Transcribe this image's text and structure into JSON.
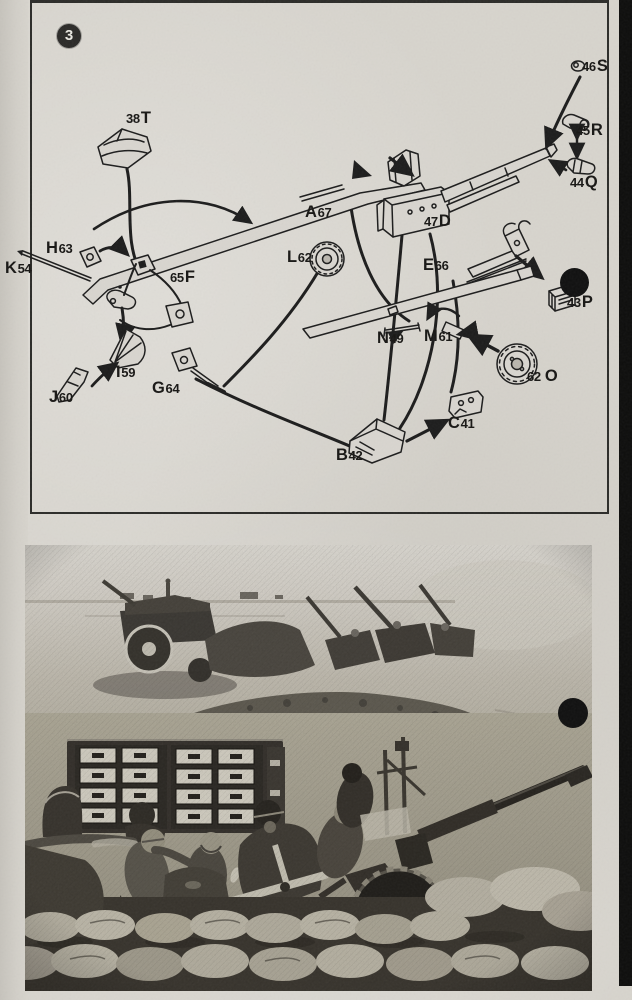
{
  "colors": {
    "paper": "#d7d4cd",
    "ink": "#1c1c1c"
  },
  "page": {
    "step_number": "3"
  },
  "diagram": {
    "parts": {
      "38T": {
        "num": "38",
        "letter": "T"
      },
      "46S": {
        "num": "46",
        "letter": "S"
      },
      "45R": {
        "num": "45",
        "letter": "R"
      },
      "44Q": {
        "num": "44",
        "letter": "Q"
      },
      "47D": {
        "num": "47",
        "letter": "D"
      },
      "A67": {
        "letter": "A",
        "num": "67"
      },
      "L62": {
        "letter": "L",
        "num": "62"
      },
      "E66": {
        "letter": "E",
        "num": "66"
      },
      "H63": {
        "letter": "H",
        "num": "63"
      },
      "K54": {
        "letter": "K",
        "num": "54"
      },
      "65F": {
        "num": "65",
        "letter": "F"
      },
      "N49": {
        "letter": "N",
        "num": "49"
      },
      "M61": {
        "letter": "M",
        "num": "61"
      },
      "43P": {
        "num": "43",
        "letter": "P"
      },
      "62O": {
        "num": "62",
        "letter": "O"
      },
      "I59": {
        "letter": "I",
        "num": "59"
      },
      "J60": {
        "letter": "J",
        "num": "60"
      },
      "G64": {
        "letter": "G",
        "num": "64"
      },
      "B42": {
        "letter": "B",
        "num": "42"
      },
      "C41": {
        "letter": "C",
        "num": "41"
      }
    }
  }
}
